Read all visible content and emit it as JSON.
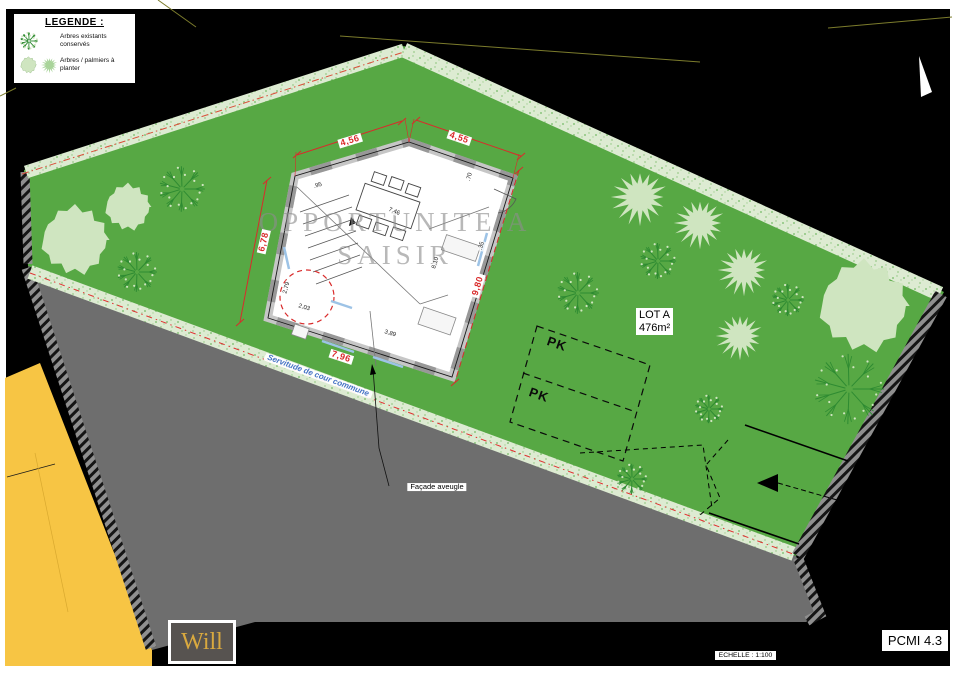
{
  "legend": {
    "title": "LEGENDE :",
    "items": [
      {
        "icon": "existing-tree-icon",
        "label": "Arbres existants conservés"
      },
      {
        "icon": "planted-tree-icon",
        "label": "Arbres / palmiers à planter"
      }
    ]
  },
  "plan": {
    "watermark": {
      "line1": "OPPORTUNITE A",
      "line2": "SAISIR"
    },
    "lot": {
      "name": "LOT A",
      "area": "476m²"
    },
    "parking": {
      "label1": "PK",
      "label2": "PK"
    },
    "servitude_label": "Servitude de cour commune",
    "facade_label": "Façade aveugle",
    "dimensions": {
      "top_left": "4,56",
      "top_right": "4,55",
      "left": "6,78",
      "right": "9,80",
      "bottom": "7,96"
    },
    "interior_dimensions": {
      "a": "2,79",
      "b": "2,03",
      "c": "3,89",
      "d": "8,10",
      "e": "7,46",
      "f": ".95",
      "g": ".35",
      "h": ".70"
    }
  },
  "footer": {
    "logo": "Will",
    "scale": "ECHELLE : 1:100",
    "sheet": "PCMI 4.3"
  },
  "colors": {
    "grass": "#57A844",
    "hedge": "#DDEBD2",
    "road": "#6E6E6E",
    "adjacent_lot": "#F7C544",
    "dimension_red": "#D92B2B",
    "servitude_blue": "#4472C4",
    "logo_gold": "#D9A93F"
  },
  "trees": [
    {
      "type": "plant-circle",
      "x": 75,
      "y": 240,
      "r": 34
    },
    {
      "type": "plant-circle",
      "x": 128,
      "y": 207,
      "r": 23
    },
    {
      "type": "plant-circle",
      "x": 864,
      "y": 306,
      "r": 45
    },
    {
      "type": "plant-star",
      "x": 640,
      "y": 197,
      "r": 30
    },
    {
      "type": "plant-star",
      "x": 700,
      "y": 223,
      "r": 27
    },
    {
      "type": "plant-star",
      "x": 744,
      "y": 270,
      "r": 27
    },
    {
      "type": "plant-star",
      "x": 740,
      "y": 336,
      "r": 25
    },
    {
      "type": "existing",
      "x": 182,
      "y": 189,
      "r": 24
    },
    {
      "type": "existing",
      "x": 137,
      "y": 272,
      "r": 21
    },
    {
      "type": "existing",
      "x": 578,
      "y": 293,
      "r": 22
    },
    {
      "type": "existing",
      "x": 658,
      "y": 261,
      "r": 19
    },
    {
      "type": "existing",
      "x": 788,
      "y": 300,
      "r": 17
    },
    {
      "type": "existing",
      "x": 849,
      "y": 389,
      "r": 37
    },
    {
      "type": "existing",
      "x": 709,
      "y": 409,
      "r": 15
    },
    {
      "type": "existing",
      "x": 632,
      "y": 479,
      "r": 16
    }
  ]
}
